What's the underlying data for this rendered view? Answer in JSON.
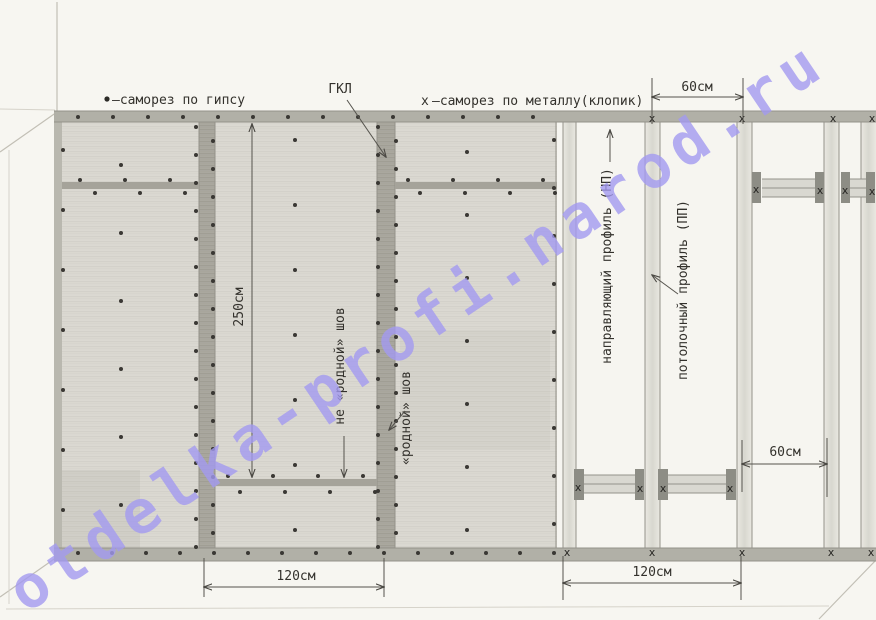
{
  "watermark": {
    "text": "otdelka-profi.narod.ru",
    "color": "#a29af0"
  },
  "legend": {
    "gypsum_symbol": "•",
    "gypsum_label": "—саморез по гипсу",
    "metal_symbol": "х",
    "metal_label": "—саморез по металлу(клопик)",
    "gkl_label": "ГКЛ"
  },
  "dimensions": {
    "top_spacing": "60см",
    "mid_spacing": "60см",
    "sheet_height": "250см",
    "sheet_width": "120см",
    "frame_spacing": "120см"
  },
  "labels": {
    "seam_nonfactory": "не «родной» шов",
    "seam_factory": "«родной» шов",
    "profile_guide": "направляющий профиль (НП)",
    "profile_ceiling": "потолочный профиль (ПП)"
  },
  "screws": {
    "metal_mark_symbol": "х",
    "metal_marks": [
      [
        652,
        118
      ],
      [
        742,
        118
      ],
      [
        833,
        118
      ],
      [
        872,
        118
      ],
      [
        567,
        552
      ],
      [
        652,
        552
      ],
      [
        742,
        552
      ],
      [
        831,
        552
      ],
      [
        871,
        552
      ],
      [
        756,
        189
      ],
      [
        820,
        190
      ],
      [
        845,
        190
      ],
      [
        872,
        191
      ],
      [
        578,
        487
      ],
      [
        640,
        488
      ],
      [
        663,
        488
      ],
      [
        730,
        488
      ]
    ],
    "gypsum_columns": [
      {
        "x": 63,
        "y": 150,
        "dy": 60,
        "n": 7
      },
      {
        "x": 196,
        "y": 127,
        "dy": 28,
        "n": 16
      },
      {
        "x": 213,
        "y": 141,
        "dy": 28,
        "n": 15
      },
      {
        "x": 378,
        "y": 127,
        "dy": 28,
        "n": 16
      },
      {
        "x": 396,
        "y": 141,
        "dy": 28,
        "n": 15
      },
      {
        "x": 554,
        "y": 140,
        "dy": 48,
        "n": 9
      },
      {
        "x": 121,
        "y": 165,
        "dy": 68,
        "n": 6
      },
      {
        "x": 295,
        "y": 140,
        "dy": 65,
        "n": 7
      },
      {
        "x": 467,
        "y": 152,
        "dy": 63,
        "n": 7
      }
    ],
    "gypsum_rows": [
      {
        "y": 117,
        "x": 78,
        "dx": 35,
        "n": 14
      },
      {
        "y": 553,
        "x": 78,
        "dx": 34,
        "n": 15
      },
      {
        "y": 180,
        "x": 80,
        "dx": 45,
        "n": 3
      },
      {
        "y": 193,
        "x": 95,
        "dx": 45,
        "n": 3
      },
      {
        "y": 180,
        "x": 408,
        "dx": 45,
        "n": 4
      },
      {
        "y": 193,
        "x": 420,
        "dx": 45,
        "n": 4
      },
      {
        "y": 476,
        "x": 228,
        "dx": 45,
        "n": 4
      },
      {
        "y": 492,
        "x": 240,
        "dx": 45,
        "n": 4
      }
    ]
  },
  "colors": {
    "pencil": "#3a3834",
    "band": "#aeada4"
  }
}
